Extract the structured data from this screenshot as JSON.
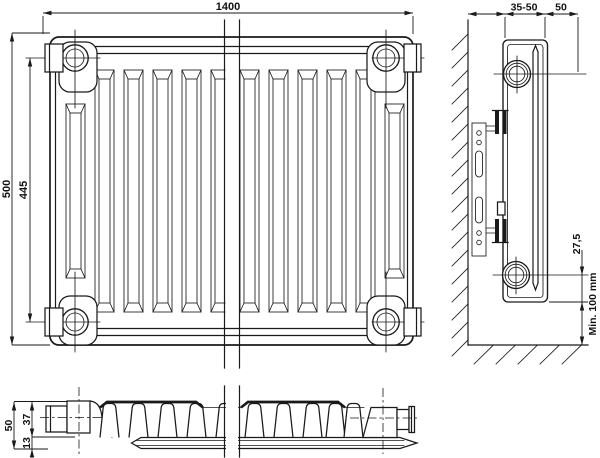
{
  "drawing": {
    "kind": "panel-radiator technical drawing",
    "colors": {
      "line": "#1a1a1a",
      "background": "#ffffff"
    },
    "front_view": {
      "width_label": "1400",
      "height_label": "500",
      "connection_spacing_label": "445"
    },
    "side_view": {
      "wall_distance_label": "35-50",
      "depth_label": "50",
      "pipe_offset_label": "27,5",
      "floor_clearance_label": "Min. 100 mm"
    },
    "bottom_view": {
      "depth_label": "50",
      "upper_segment_label": "37",
      "lower_segment_label": "13"
    }
  }
}
